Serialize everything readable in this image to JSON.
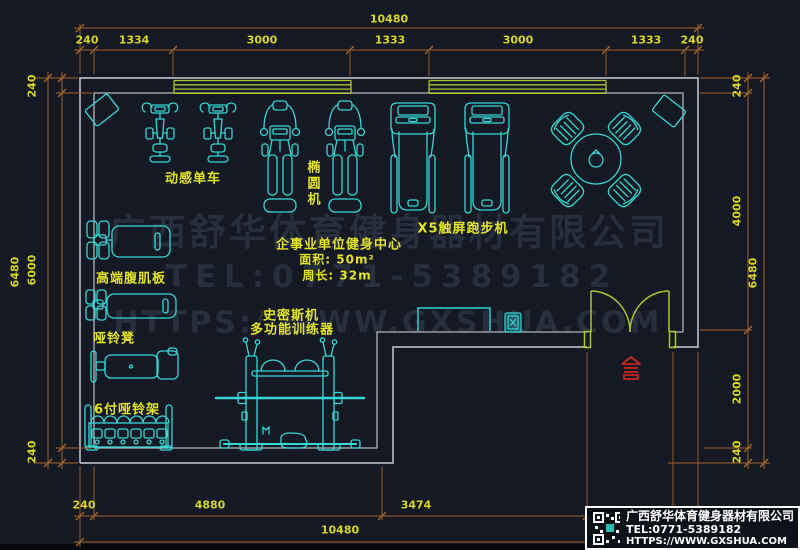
{
  "dims": {
    "top": {
      "total": "10480",
      "segments": [
        "240",
        "1334",
        "3000",
        "1333",
        "3000",
        "1333",
        "240"
      ]
    },
    "bottom": {
      "total": "10480",
      "segments": [
        "240",
        "4880",
        "3474"
      ]
    },
    "left": {
      "total": "6480",
      "segments": [
        "240",
        "6000",
        "240"
      ]
    },
    "right": {
      "total": "6480",
      "segments": [
        "240",
        "4000",
        "2000",
        "240"
      ]
    }
  },
  "equipment_labels": {
    "spin_bike": "动感单车",
    "elliptical": "椭圆机",
    "treadmill": "X5触屏跑步机",
    "ab_board": "高端腹肌板",
    "dumbbell_bench": "哑铃凳",
    "dumbbell_rack": "6付哑铃架",
    "smith_line1": "史密斯机",
    "smith_line2": "多功能训练器"
  },
  "room_info": {
    "title": "企事业单位健身中心",
    "area": "面积: 50m²",
    "perimeter": "周长: 32m"
  },
  "watermark": {
    "line1": "广西舒华体育健身器材有限公司",
    "line2": "TEL:0771-5389182",
    "line3": "HTTPS://WWW.GXSHUA.COM"
  },
  "logo": {
    "company": "广西舒华体育健身器材有限公司",
    "tel": "TEL:0771-5389182",
    "url": "HTTPS://WWW.GXSHUA.COM"
  },
  "colors": {
    "background": "#141923",
    "equipment": "#35d8d6",
    "label": "#e3e326",
    "dimension": "#a5632a",
    "dim_text": "#d6d622",
    "wall": "#b2b6bc",
    "window_door": "#aec32e",
    "red_marker": "#c5271c",
    "watermark": "#272e3c"
  }
}
